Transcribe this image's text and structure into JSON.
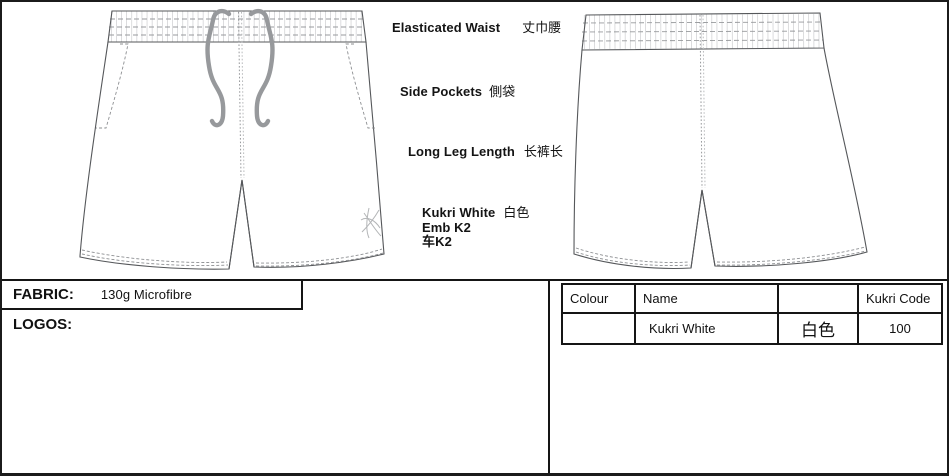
{
  "annotations": {
    "waist": {
      "en": "Elasticated Waist",
      "zh": "丈巾腰"
    },
    "pockets": {
      "en": "Side Pockets",
      "zh": "側袋"
    },
    "leg_length": {
      "en": "Long Leg Length",
      "zh": "长裤长"
    },
    "logo": {
      "line1_en": "Kukri White",
      "line1_zh": "白色",
      "line2": "Emb K2",
      "line3": "车K2"
    }
  },
  "fabric": {
    "label": "FABRIC:",
    "value": "130g Microfibre"
  },
  "logos": {
    "label": "LOGOS:"
  },
  "colour_table": {
    "headers": [
      "Colour",
      "Name",
      "",
      "Kukri Code"
    ],
    "rows": [
      {
        "colour": "",
        "name": "Kukri White",
        "name_zh": "白色",
        "code": "100"
      }
    ]
  },
  "icons": {
    "kukri_logo": "kukri-embroidery-emblem",
    "drawstring": "waist-drawcord"
  },
  "colors": {
    "outline": "#55575a",
    "stitch": "#8d8f92",
    "tick": "#c6c8ca",
    "drawcord": "#97999c",
    "logo_mark": "#b3b5b7",
    "frame": "#151515"
  }
}
